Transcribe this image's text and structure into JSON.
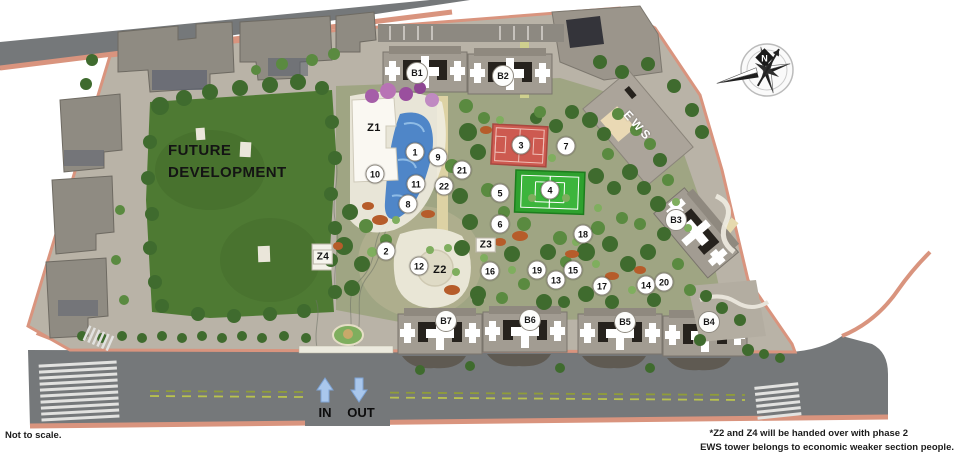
{
  "notes": {
    "not_to_scale": "Not to scale.",
    "footnote_line1": "*Z2 and Z4 will be handed over with phase 2",
    "footnote_line2": "EWS tower belongs to economic weaker section people."
  },
  "labels": {
    "future_development": "FUTURE DEVELOPMENT",
    "compass_north": "N",
    "gate_in": "IN",
    "gate_out": "OUT",
    "ews": "EWS"
  },
  "towers": [
    {
      "label": "B1",
      "x": 417,
      "y": 73
    },
    {
      "label": "B2",
      "x": 503,
      "y": 76
    },
    {
      "label": "B3",
      "x": 676,
      "y": 220
    },
    {
      "label": "B4",
      "x": 709,
      "y": 322
    },
    {
      "label": "B5",
      "x": 625,
      "y": 322
    },
    {
      "label": "B6",
      "x": 530,
      "y": 320
    },
    {
      "label": "B7",
      "x": 446,
      "y": 321
    }
  ],
  "zones": [
    {
      "label": "Z1",
      "x": 374,
      "y": 128,
      "chip": false
    },
    {
      "label": "Z2",
      "x": 440,
      "y": 270,
      "chip": false
    },
    {
      "label": "Z3",
      "x": 486,
      "y": 245,
      "chip": true
    },
    {
      "label": "Z4",
      "x": 323,
      "y": 257,
      "chip": true
    }
  ],
  "markers": [
    {
      "n": "1",
      "x": 415,
      "y": 152
    },
    {
      "n": "2",
      "x": 386,
      "y": 251
    },
    {
      "n": "3",
      "x": 521,
      "y": 145
    },
    {
      "n": "4",
      "x": 550,
      "y": 190
    },
    {
      "n": "5",
      "x": 500,
      "y": 193
    },
    {
      "n": "6",
      "x": 500,
      "y": 224
    },
    {
      "n": "7",
      "x": 566,
      "y": 146
    },
    {
      "n": "8",
      "x": 408,
      "y": 204
    },
    {
      "n": "9",
      "x": 438,
      "y": 157
    },
    {
      "n": "10",
      "x": 375,
      "y": 174
    },
    {
      "n": "11",
      "x": 416,
      "y": 184
    },
    {
      "n": "12",
      "x": 419,
      "y": 266
    },
    {
      "n": "13",
      "x": 556,
      "y": 280
    },
    {
      "n": "14",
      "x": 646,
      "y": 285
    },
    {
      "n": "15",
      "x": 573,
      "y": 270
    },
    {
      "n": "16",
      "x": 490,
      "y": 271
    },
    {
      "n": "17",
      "x": 602,
      "y": 286
    },
    {
      "n": "18",
      "x": 583,
      "y": 234
    },
    {
      "n": "19",
      "x": 537,
      "y": 270
    },
    {
      "n": "20",
      "x": 664,
      "y": 282
    },
    {
      "n": "21",
      "x": 462,
      "y": 170
    },
    {
      "n": "22",
      "x": 444,
      "y": 186
    }
  ],
  "colors": {
    "road_gray": "#75787a",
    "sidewalk_salmon": "#d9947e",
    "lawn_green": "#4e7a33",
    "court_red": "#cd5a50",
    "court_green": "#2ea12e",
    "pool_blue": "#4f86c8",
    "path_cream": "#ddd2a4",
    "tower_gray": "#a29c92",
    "arrow_blue": "#a9c7ec"
  }
}
